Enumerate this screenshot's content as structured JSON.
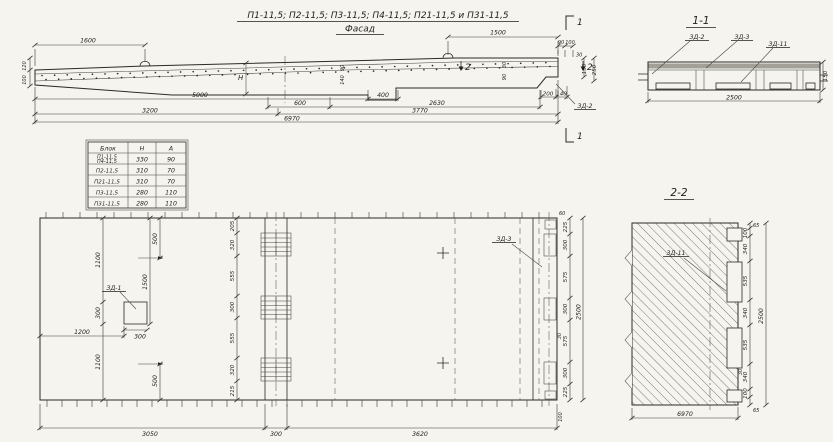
{
  "title": {
    "series": "П1-11,5; П2-11,5; П3-11,5; П4-11,5; П21-11,5 и П31-11,5",
    "view_label": "Фасад"
  },
  "elevation": {
    "dim_top_left": "1600",
    "dim_top_right": "1500",
    "left_heights": [
      "120",
      "100"
    ],
    "mid_heights": [
      "90",
      "140"
    ],
    "mid_heights2": [
      "30",
      "90"
    ],
    "height_symbol": "Н",
    "end_top": [
      "90",
      "100"
    ],
    "end_30": "30",
    "end_150": "150",
    "end_250": "250",
    "end_bottom": [
      "200",
      "140"
    ],
    "chain1": [
      "5000",
      "400"
    ],
    "chain2": [
      "600",
      "2630"
    ],
    "chain3": [
      "3200",
      "3770"
    ],
    "total": "6970",
    "label_zd2": "ЗД-2",
    "cut1": "1",
    "cut2": "2"
  },
  "section11": {
    "title": "1-1",
    "label_zd2": "ЗД-2",
    "label_zd3": "ЗД-3",
    "label_zd11": "ЗД-11",
    "width": "2500",
    "height": "150"
  },
  "table": {
    "headers": [
      "Блок",
      "Н",
      "А"
    ],
    "rows": [
      {
        "name": "П1-11,5",
        "name2": "П4-11,5",
        "h": "330",
        "a": "90"
      },
      {
        "name": "П2-11,5",
        "name2": "",
        "h": "310",
        "a": "70"
      },
      {
        "name": "П21-11,5",
        "name2": "",
        "h": "310",
        "a": "70"
      },
      {
        "name": "П3-11,5",
        "name2": "",
        "h": "280",
        "a": "110"
      },
      {
        "name": "П31-11,5",
        "name2": "",
        "h": "280",
        "a": "110"
      }
    ]
  },
  "plan": {
    "label_zd1": "ЗД-1",
    "label_zd3": "ЗД-3",
    "left_chain": [
      "1100",
      "300",
      "1100"
    ],
    "dim_1200": "1200",
    "dim_300": "300",
    "dim_1500": "1500",
    "dim_500_top": "500",
    "dim_500_bottom": "500",
    "mid_chain": [
      "205",
      "320",
      "555",
      "300",
      "555",
      "320",
      "215"
    ],
    "right_chain": [
      "225",
      "300",
      "575",
      "300",
      "575",
      "300",
      "225"
    ],
    "right_60": "60",
    "right_30": "30",
    "right_100": "100",
    "right_total": "2500",
    "bottom_chain": [
      "3050",
      "300",
      "3620"
    ]
  },
  "section22": {
    "title": "2-2",
    "label_zd11": "ЗД-11",
    "right_chain": [
      "65",
      "100",
      "340",
      "535",
      "340",
      "535",
      "340",
      "100",
      "65"
    ],
    "small_30": "30",
    "right_total": "2500",
    "bottom": "6970"
  }
}
